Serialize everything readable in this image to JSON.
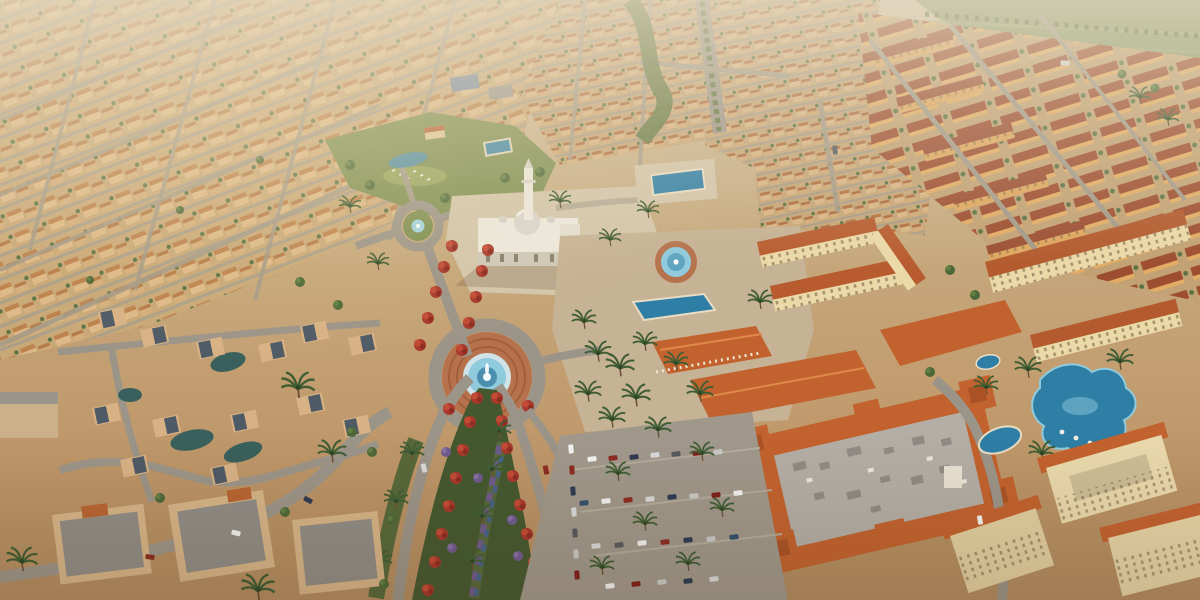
{
  "scene": {
    "type": "architectural-aerial-render",
    "description": "Golden-hour aerial rendering of a master-planned desert community: endless rows of sand-colored villas, a white mosque with dome and minaret, a grand fountain roundabout, a boulevard median of red flowering trees, blue pools, a terracotta-roofed retail center with parking, and mid-rise apartment blocks fading to hazy green farmland.",
    "time_of_day": "golden-hour",
    "landmarks": [
      {
        "id": "mosque",
        "label": "white community mosque with central dome and minaret"
      },
      {
        "id": "minaret",
        "label": "tall white minaret tower"
      },
      {
        "id": "grand-fountain-roundabout",
        "label": "circular brick fountain plaza with water jets"
      },
      {
        "id": "plaza-fountain",
        "label": "round splash fountain on the retail plaza"
      },
      {
        "id": "traffic-circle",
        "label": "small landscaped traffic circle with fountain"
      },
      {
        "id": "flower-boulevard",
        "label": "boulevard median planted with red flowering trees and purple flower braids"
      },
      {
        "id": "community-park",
        "label": "lawn park with pond, loungers and amenity pool"
      },
      {
        "id": "lap-pool",
        "label": "angular blue lap pool"
      },
      {
        "id": "lagoon-pool",
        "label": "free-form resort lagoon pool"
      },
      {
        "id": "retail-center",
        "label": "terracotta-roofed retail center with rooftop equipment"
      },
      {
        "id": "parking-lot",
        "label": "surface parking lot with rows of cars"
      },
      {
        "id": "villa-district",
        "label": "rows of sand-colored villas receding to the horizon"
      },
      {
        "id": "apartment-district",
        "label": "mid-rise apartment blocks with red-brown roofs"
      },
      {
        "id": "courtyard-villas",
        "label": "courtyard villas with dark plunge pools"
      },
      {
        "id": "farmland",
        "label": "hazy green fields beyond the development"
      }
    ]
  },
  "palette": {
    "haze": "#e8dec8",
    "ground_tan": "#c7ab80",
    "road_gray": "#9b9488",
    "asphalt": "#a0988b",
    "villa_tan": "#dcb988",
    "villa_roof": "#bd824d",
    "roof_terracotta": "#c2622e",
    "flat_roof_gray": "#b3aea6",
    "apartment_roof": "#9c4f33",
    "apartment_wall": "#dfa75f",
    "cream_wall": "#ecd9a8",
    "mosque_wall": "#ece8dd",
    "dome_gray": "#d8d5cc",
    "plaza_brick": "#b5724d",
    "fountain_water": "#8fcadd",
    "pool_blue": "#2e7ea6",
    "lagoon_teal": "#39605c",
    "lawn_green": "#7d8e50",
    "median_green": "#44582f",
    "field_green": "#8a9a68",
    "palm_green": "#3f5d33",
    "red_tree": "#a8392c",
    "purple_tree": "#6f5a8e"
  }
}
